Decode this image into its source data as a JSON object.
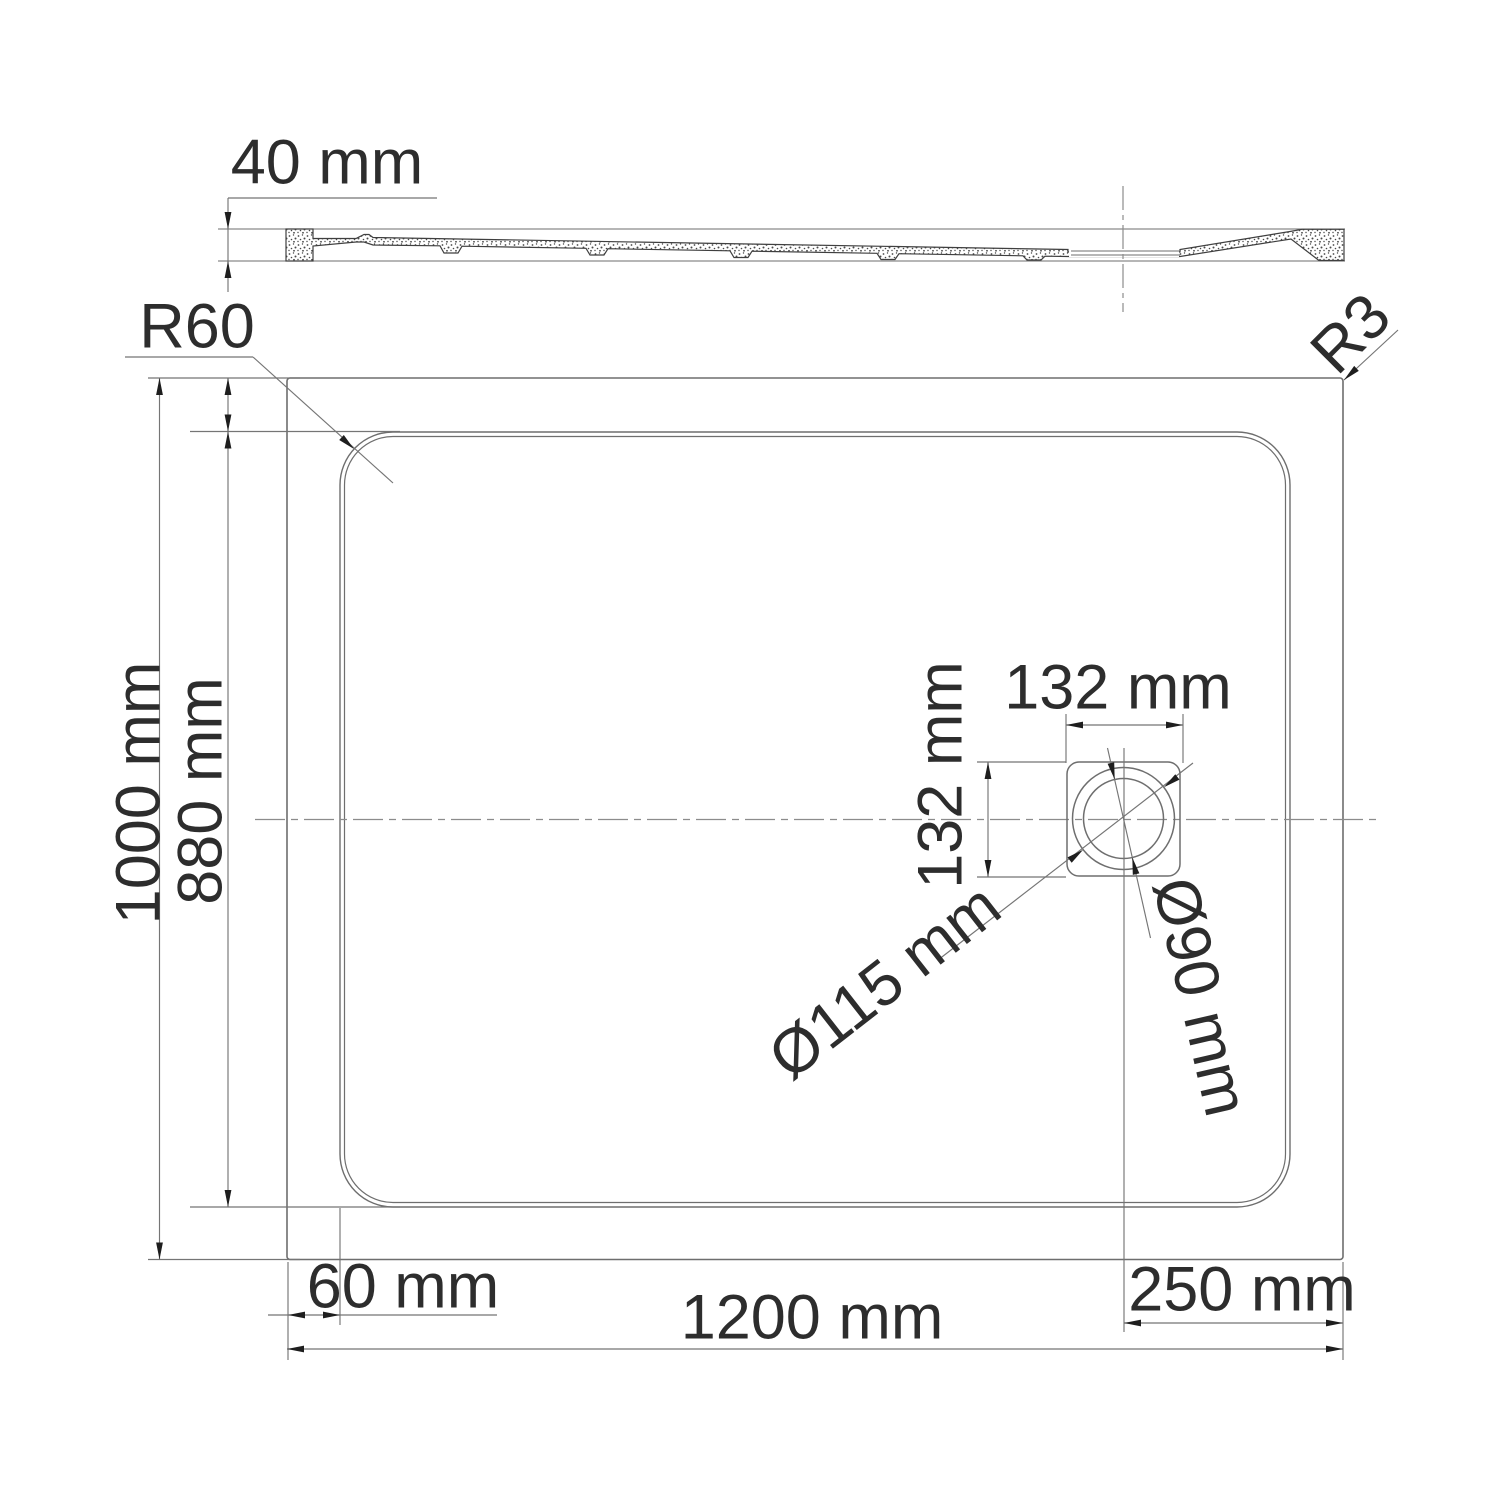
{
  "title": "Shower tray technical drawing",
  "units": "mm",
  "colors": {
    "bg": "#ffffff",
    "line": "#6e6e6e",
    "section": "#3f3f3f",
    "dim": "#757575",
    "arrow": "#1e1e1e",
    "text": "#2d2d2d",
    "center": "#8c8c8c"
  },
  "views": {
    "section": {
      "thickness": "40 mm"
    },
    "plan": {
      "outer_width": "1200 mm",
      "outer_height": "1000 mm",
      "basin_height": "880 mm",
      "edge_offset": "60 mm",
      "corner_radius_basin": "R60",
      "corner_radius_outer": "R3",
      "drain": {
        "offset_from_right": "250 mm",
        "box_width": "132 mm",
        "box_height": "132 mm",
        "outer_diameter": "Ø115 mm",
        "inner_diameter": "Ø90 mm"
      }
    }
  }
}
